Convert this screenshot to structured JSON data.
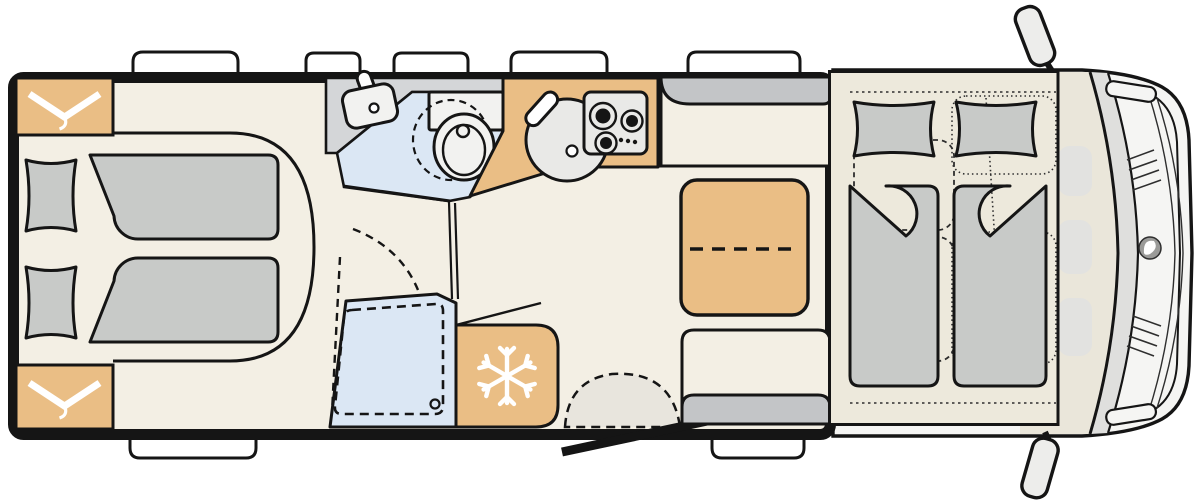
{
  "palette": {
    "background": "#ffffff",
    "white": "#ffffff",
    "wall": "#151515",
    "detail_line": "#2e2e2e",
    "floor": "#f3efe4",
    "platform": "#ede9dc",
    "tan": "#eabe85",
    "gray_furniture": "#c8cac8",
    "bench_gray": "#c3c5c7",
    "counter_gray": "#d4d6d8",
    "blue": "#dbe7f4",
    "appliance_gray": "#e9e9e7",
    "fixture_white": "#f2f2f0",
    "cab_body": "#f5f5f3",
    "glass_gray": "#dfdfdd",
    "cab_floor": "#eae6da",
    "cab_blob": "#e2e2e0",
    "mirror_gray": "#ededeb",
    "step_gray": "#e8e5dd",
    "logo_gray": "#9b9b99",
    "icon_white": "#ffffff"
  },
  "icons": {
    "hanger": "clothes hanger (wardrobe)",
    "snowflake": "snowflake (refrigerator)",
    "burner": "gas hob burner ring",
    "brand_logo": "vehicle brand emblem"
  },
  "counts": {
    "roof_windows_top": 5,
    "windows_bottom": 2,
    "hob_burners": 3,
    "hob_knob_dots": 3,
    "rear_single_beds": 2,
    "drop_down_bed_pillows": 2,
    "wardrobes": 2,
    "side_mirrors": 2
  },
  "areas": {
    "floorplan": {
      "label": "Motorhome floor plan, top view"
    },
    "rear_beds": {
      "label": "Rear twin single beds"
    },
    "wardrobe_top": {
      "label": "Wardrobe"
    },
    "wardrobe_bottom": {
      "label": "Wardrobe"
    },
    "washroom": {
      "label": "Washroom with washbasin and swivel toilet"
    },
    "washbasin": {
      "label": "Washbasin"
    },
    "toilet": {
      "label": "Swivel toilet"
    },
    "shower": {
      "label": "Shower cubicle with drain"
    },
    "kitchen": {
      "label": "Kitchen block with round sink and 3-burner hob"
    },
    "kitchen_sink": {
      "label": "Round kitchen sink"
    },
    "hob": {
      "label": "3-burner gas hob"
    },
    "fridge": {
      "label": "Refrigerator"
    },
    "entry_step": {
      "label": "Entry step area"
    },
    "entry_door": {
      "label": "Entry door, shown open"
    },
    "front_bench": {
      "label": "Forward-facing bench seat"
    },
    "rear_bench": {
      "label": "Bench seat at entry"
    },
    "table": {
      "label": "Dinette table with folding extension"
    },
    "dropdown_bed": {
      "label": "Drop-down double bed over cab"
    },
    "cab_seats": {
      "label": "Swivelled driver and passenger seats (dashed outline)"
    },
    "cab": {
      "label": "Driver cab with windshield and dashboard"
    },
    "mirror_top": {
      "label": "Exterior side mirror"
    },
    "mirror_bottom": {
      "label": "Exterior side mirror"
    },
    "roof_windows": {
      "label": "Roof windows and skylights"
    },
    "side_windows": {
      "label": "Side windows"
    }
  }
}
